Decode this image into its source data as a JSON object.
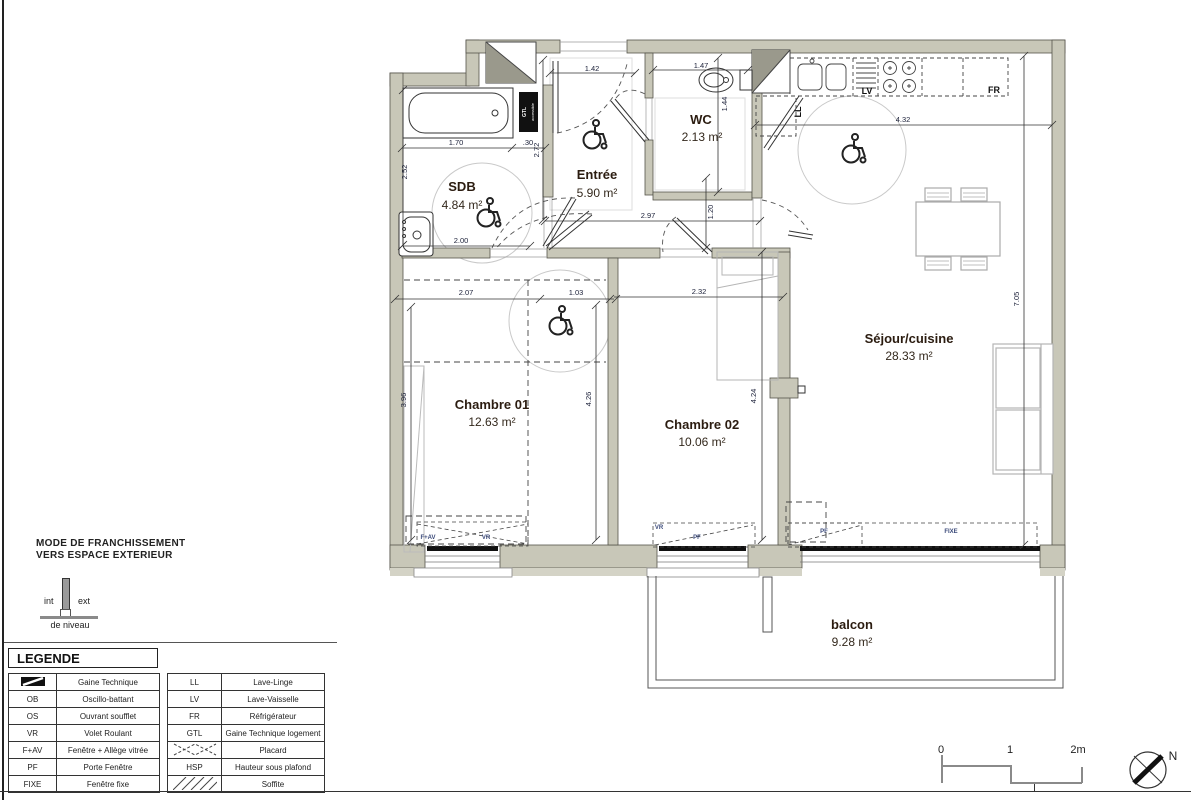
{
  "plan": {
    "rooms": [
      {
        "name": "SDB",
        "area": "4.84 m²"
      },
      {
        "name": "Entrée",
        "area": "5.90 m²"
      },
      {
        "name": "WC",
        "area": "2.13 m²"
      },
      {
        "name": "Séjour/cuisine",
        "area": "28.33 m²"
      },
      {
        "name": "Chambre 01",
        "area": "12.63 m²"
      },
      {
        "name": "Chambre 02",
        "area": "10.06 m²"
      },
      {
        "name": "balcon",
        "area": "9.28 m²"
      }
    ],
    "dimensions": {
      "entree_width": "1.42",
      "wc_width": "1.47",
      "bath_length": "1.70",
      "bath_offset": ".30",
      "sdb_depth": "2.52",
      "entree_depth": "2.72",
      "wc_depth": "1.44",
      "hall_depth": "1.20",
      "hall_width": "2.97",
      "sejour_width": "4.32",
      "sejour_depth": "7.05",
      "ch1_width": "2.07",
      "ch1_door": "1.03",
      "ch2_width": "2.32",
      "ch1_depth": "3.96",
      "ch1_inner_depth": "4.26",
      "ch2_depth": "4.24",
      "sdb_width": "2.00"
    },
    "window_labels": {
      "ch1_fav": "F+AV",
      "ch1_vr": "VR",
      "ch2_vr": "VR",
      "ch2_pf": "PF",
      "sejour_pf": "PF",
      "sejour_fixe": "FIXE"
    },
    "appliances": {
      "lv": "LV",
      "fr": "FR",
      "ll": "LL",
      "gtl": "GTL",
      "gtl_note": "accessible"
    }
  },
  "exterior_note": {
    "line1": "MODE DE FRANCHISSEMENT",
    "line2": "VERS ESPACE EXTERIEUR",
    "int_label": "int",
    "ext_label": "ext",
    "level_label": "de niveau"
  },
  "legend": {
    "title": "LEGENDE",
    "left_rows": [
      {
        "abbr": "",
        "label": "Gaine Technique"
      },
      {
        "abbr": "OB",
        "label": "Oscillo-battant"
      },
      {
        "abbr": "OS",
        "label": "Ouvrant soufflet"
      },
      {
        "abbr": "VR",
        "label": "Volet Roulant"
      },
      {
        "abbr": "F+AV",
        "label": "Fenêtre + Allège vitrée"
      },
      {
        "abbr": "PF",
        "label": "Porte Fenêtre"
      },
      {
        "abbr": "FIXE",
        "label": "Fenêtre fixe"
      }
    ],
    "right_rows": [
      {
        "abbr": "LL",
        "label": "Lave-Linge"
      },
      {
        "abbr": "LV",
        "label": "Lave-Vaisselle"
      },
      {
        "abbr": "FR",
        "label": "Réfrigérateur"
      },
      {
        "abbr": "GTL",
        "label": "Gaine Technique logement"
      },
      {
        "abbr": "",
        "label": "Placard"
      },
      {
        "abbr": "HSP",
        "label": "Hauteur sous plafond"
      },
      {
        "abbr": "",
        "label": "Soffite"
      }
    ]
  },
  "scale_bar": {
    "t0": "0",
    "t1": "1",
    "t2": "2m"
  },
  "compass": {
    "north_label": "N"
  },
  "colors": {
    "wall": "#c8c7b8",
    "line": "#3a3a3a",
    "dimension_text": "#20253d",
    "room_text": "#2b1c10",
    "window_label_text": "#3b4a7a"
  }
}
